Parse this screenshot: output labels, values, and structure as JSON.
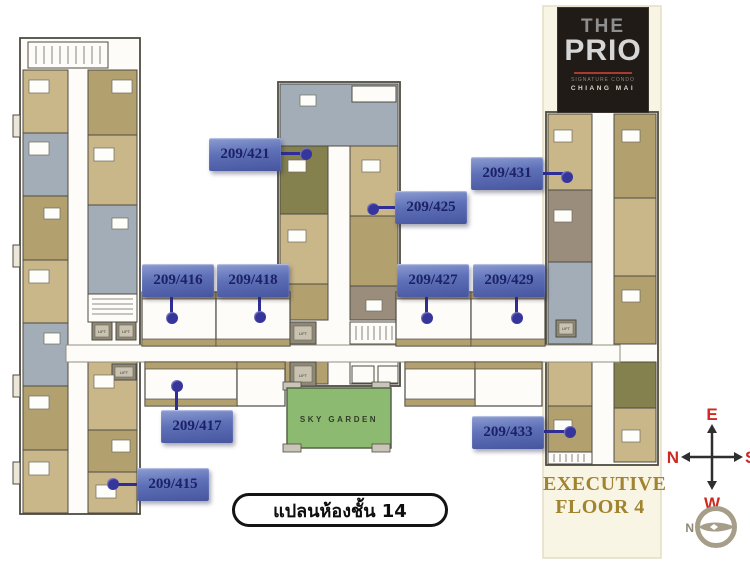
{
  "logo": {
    "line1": "THE",
    "line2": "PRIO",
    "tagline": "SIGNATURE CONDO",
    "city": "CHIANG MAI"
  },
  "units": [
    {
      "label": "209/421"
    },
    {
      "label": "209/425"
    },
    {
      "label": "209/431"
    },
    {
      "label": "209/416"
    },
    {
      "label": "209/418"
    },
    {
      "label": "209/427"
    },
    {
      "label": "209/429"
    },
    {
      "label": "209/417"
    },
    {
      "label": "209/433"
    },
    {
      "label": "209/415"
    }
  ],
  "floor_label": "แปลนห้องชั้น 14",
  "executive": {
    "line1": "EXECUTIVE",
    "line2": "FLOOR 4"
  },
  "sky_garden_label": "SKY GARDEN",
  "lift_label": "LIFT",
  "compass": {
    "top": "E",
    "left": "N",
    "right": "S",
    "bottom": "W",
    "badge": "N"
  },
  "colors": {
    "label_blue": "#5e70b8",
    "label_text": "#1c2265",
    "cream_strip": "#f9f5e5",
    "executive_gold": "#a0842f",
    "sky_garden_green": "#8cba70",
    "compass_red": "#cf2921",
    "unit_tan": "#c9b689",
    "unit_dark_tan": "#b3a06f",
    "unit_grey": "#a3adb8",
    "unit_olive": "#84814f"
  }
}
